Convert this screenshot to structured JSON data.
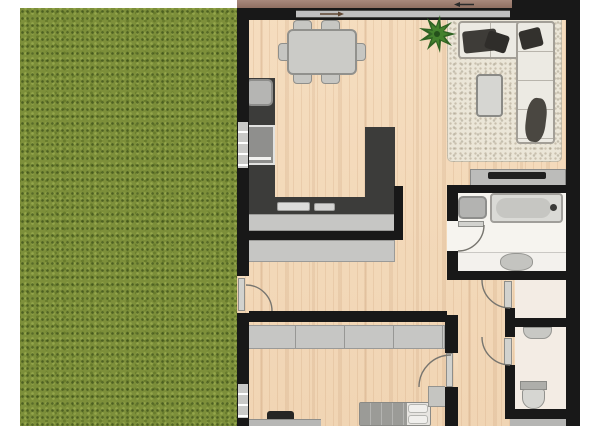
{
  "scene": {
    "type": "floor-plan",
    "view": "top-down 2D architectural render, no text labels",
    "areas": [
      {
        "name": "garden",
        "label": "Garden lawn",
        "surface": "grass",
        "position": "left strip"
      },
      {
        "name": "living-dining",
        "label": "Open-plan living and dining room",
        "surface": "light wood",
        "position": "top of plan"
      },
      {
        "name": "kitchen",
        "label": "Kitchen (U-shaped dark counters)",
        "surface": "light wood",
        "position": "mid-left"
      },
      {
        "name": "hallway",
        "label": "Hallway corridor",
        "surface": "light wood",
        "position": "center, L-shaped"
      },
      {
        "name": "bathroom",
        "label": "Bathroom with tub, shower and vanity",
        "surface": "white tile",
        "position": "mid-right"
      },
      {
        "name": "small-room",
        "label": "Small storage room",
        "surface": "light tile",
        "position": "right, between bathroom and WC"
      },
      {
        "name": "wc",
        "label": "WC with toilet and hand basin",
        "surface": "light tile",
        "position": "bottom right"
      },
      {
        "name": "bedroom",
        "label": "Bedroom with bed, desk and wardrobe",
        "surface": "light wood",
        "position": "bottom, cut off by image edge"
      }
    ],
    "furniture": [
      {
        "name": "dining-table",
        "room": "living-dining",
        "chairs": 6
      },
      {
        "name": "potted-plant",
        "room": "living-dining"
      },
      {
        "name": "area-rug",
        "room": "living-dining"
      },
      {
        "name": "l-shaped-sofa",
        "room": "living-dining",
        "cushions": 4
      },
      {
        "name": "coffee-table",
        "room": "living-dining"
      },
      {
        "name": "tv-stand",
        "room": "living-dining"
      },
      {
        "name": "tv",
        "room": "living-dining"
      },
      {
        "name": "fridge-unit",
        "room": "kitchen"
      },
      {
        "name": "oven",
        "room": "kitchen"
      },
      {
        "name": "kitchen-sink",
        "room": "kitchen"
      },
      {
        "name": "kitchen-island",
        "room": "kitchen"
      },
      {
        "name": "sideboard",
        "room": "hallway"
      },
      {
        "name": "shower",
        "room": "bathroom"
      },
      {
        "name": "bathtub",
        "room": "bathroom"
      },
      {
        "name": "vanity-sink",
        "room": "bathroom"
      },
      {
        "name": "hand-basin",
        "room": "wc"
      },
      {
        "name": "toilet",
        "room": "wc"
      },
      {
        "name": "wardrobe",
        "room": "bedroom"
      },
      {
        "name": "desk",
        "room": "bedroom"
      },
      {
        "name": "desk-chair",
        "room": "bedroom"
      },
      {
        "name": "bed",
        "room": "bedroom",
        "pillows": 2
      },
      {
        "name": "nightstand",
        "room": "bedroom"
      }
    ],
    "openings": [
      {
        "name": "sliding-window-top",
        "type": "wide window / slider with two direction arrows",
        "wall": "top"
      },
      {
        "name": "kitchen-window",
        "type": "window",
        "wall": "left"
      },
      {
        "name": "garden-door",
        "type": "hinged door with swing arc",
        "wall": "left, hallway"
      },
      {
        "name": "bedroom-window",
        "type": "window",
        "wall": "left"
      },
      {
        "name": "bathroom-door",
        "type": "hinged door with swing arc",
        "wall": "bathroom west"
      },
      {
        "name": "small-room-door",
        "type": "hinged door with swing arc",
        "wall": "corridor east"
      },
      {
        "name": "wc-door",
        "type": "hinged door with swing arc",
        "wall": "corridor east"
      },
      {
        "name": "bedroom-door",
        "type": "hinged door with swing arc",
        "wall": "bedroom east"
      }
    ],
    "colors": {
      "background": "#ffffff",
      "grass": "#7d8f3a",
      "wood_floor": "#f2d8b8",
      "walls": "#181818",
      "kitchen_counter": "#3c3c3a",
      "light_gray_furniture": "#c6c6c4",
      "rug": "#ebe6d8",
      "sofa": "#eceae3",
      "cushion_dark": "#3e3c38",
      "bathroom_floor": "#f6f4ef",
      "side_room_floor": "#f3ece4",
      "deck_strip": "#9a7a6b",
      "plant_green": "#2f6323",
      "tv_black": "#1f1f1f"
    }
  }
}
